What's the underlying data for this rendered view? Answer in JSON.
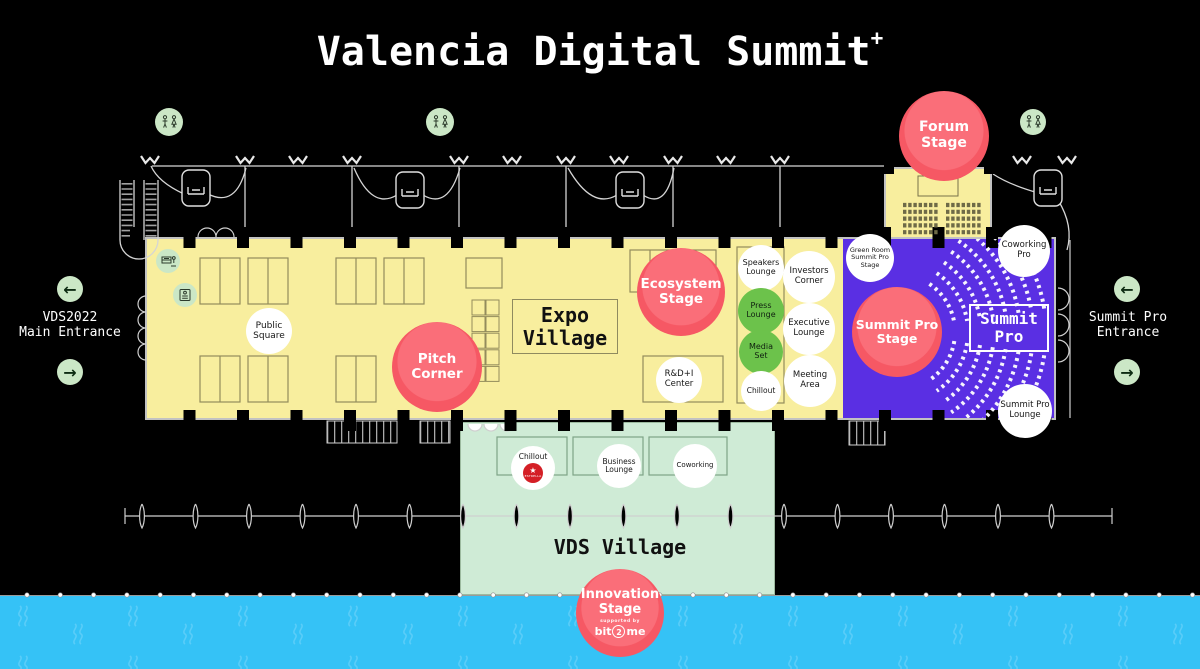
{
  "title": {
    "text": "Valencia Digital Summit",
    "sup": "+"
  },
  "entrances": {
    "main": {
      "label": "VDS2022\nMain Entrance"
    },
    "summit_pro": {
      "label": "Summit Pro\nEntrance"
    }
  },
  "icons": {
    "arrow_left": "←",
    "arrow_right": "→",
    "restroom": "restroom",
    "reception": "reception-desk",
    "accreditation": "badge"
  },
  "zones": {
    "expo_village": {
      "label": "Expo\nVillage",
      "color": "#F8EE9E"
    },
    "summit_pro": {
      "label": "Summit\nPro",
      "color": "#5A2FE3"
    },
    "vds_village": {
      "label": "VDS Village",
      "color": "#CFEBD6"
    },
    "water_color": "#35C2F6"
  },
  "stages": {
    "color": "#F65864",
    "forum": {
      "label": "Forum\nStage"
    },
    "ecosystem": {
      "label": "Ecosystem\nStage"
    },
    "pitch_corner": {
      "label": "Pitch\nCorner"
    },
    "summit_pro_stage": {
      "label": "Summit Pro\nStage"
    },
    "innovation": {
      "label": "Innovation\nStage",
      "supported_by": "supported by",
      "sponsor": {
        "bit": "bit",
        "two": "2",
        "me": "me"
      }
    }
  },
  "rooms": {
    "highlight_color": "#6CC24B",
    "public_square": {
      "label": "Public\nSquare"
    },
    "speakers_lounge": {
      "label": "Speakers\nLounge"
    },
    "press_lounge": {
      "label": "Press\nLounge"
    },
    "media_set": {
      "label": "Media\nSet"
    },
    "chillout_expo": {
      "label": "Chillout"
    },
    "investors_corner": {
      "label": "Investors\nCorner"
    },
    "executive_lounge": {
      "label": "Executive\nLounge"
    },
    "meeting_area": {
      "label": "Meeting\nArea"
    },
    "rdi_center": {
      "label": "R&D+I\nCenter"
    },
    "green_room": {
      "label": "Green Room\nSummit Pro\nStage"
    },
    "coworking_pro": {
      "label": "Coworking\nPro"
    },
    "summit_pro_lounge": {
      "label": "Summit Pro\nLounge"
    },
    "chillout_village": {
      "label": "Chillout",
      "sponsor": "ESTRELLA"
    },
    "business_lounge": {
      "label": "Business\nLounge"
    },
    "coworking": {
      "label": "Coworking"
    }
  }
}
